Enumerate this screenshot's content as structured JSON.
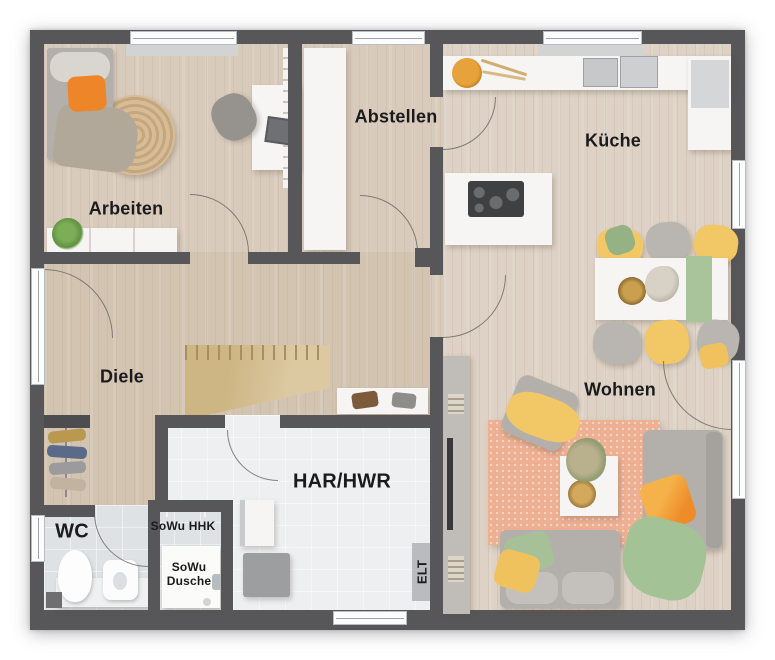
{
  "plan": {
    "type": "floor-plan",
    "rooms": {
      "arbeiten": {
        "label": "Arbeiten"
      },
      "abstellen": {
        "label": "Abstellen"
      },
      "kueche": {
        "label": "Küche"
      },
      "diele": {
        "label": "Diele"
      },
      "wohnen": {
        "label": "Wohnen"
      },
      "har_hwr": {
        "label": "HAR/HWR"
      },
      "wc": {
        "label": "WC"
      },
      "sowu_hhk": {
        "label": "SoWu HHK"
      },
      "sowu_dusche": {
        "label": "SoWu Dusche"
      },
      "elt": {
        "label": "ELT"
      }
    },
    "colors": {
      "wall": "#57575a",
      "wood_floor": "#d9cbbc",
      "wood_floor_dark": "#d3c4b2",
      "wood_floor_light": "#ddd2c5",
      "tile_floor": "#dfe2e4",
      "tile_floor_light": "#edeff0",
      "furniture_white": "#f6f5f3",
      "furniture_gray": "#b3b0ab",
      "accent_orange": "#ec8629",
      "accent_yellow": "#f2c765",
      "accent_green": "#a3c295",
      "rug_salmon": "#eeb093",
      "rug_jute": "#cdb392",
      "stairs_wood": "#d6c194",
      "appliance_dark": "#3f4042",
      "background": "#ffffff"
    }
  }
}
